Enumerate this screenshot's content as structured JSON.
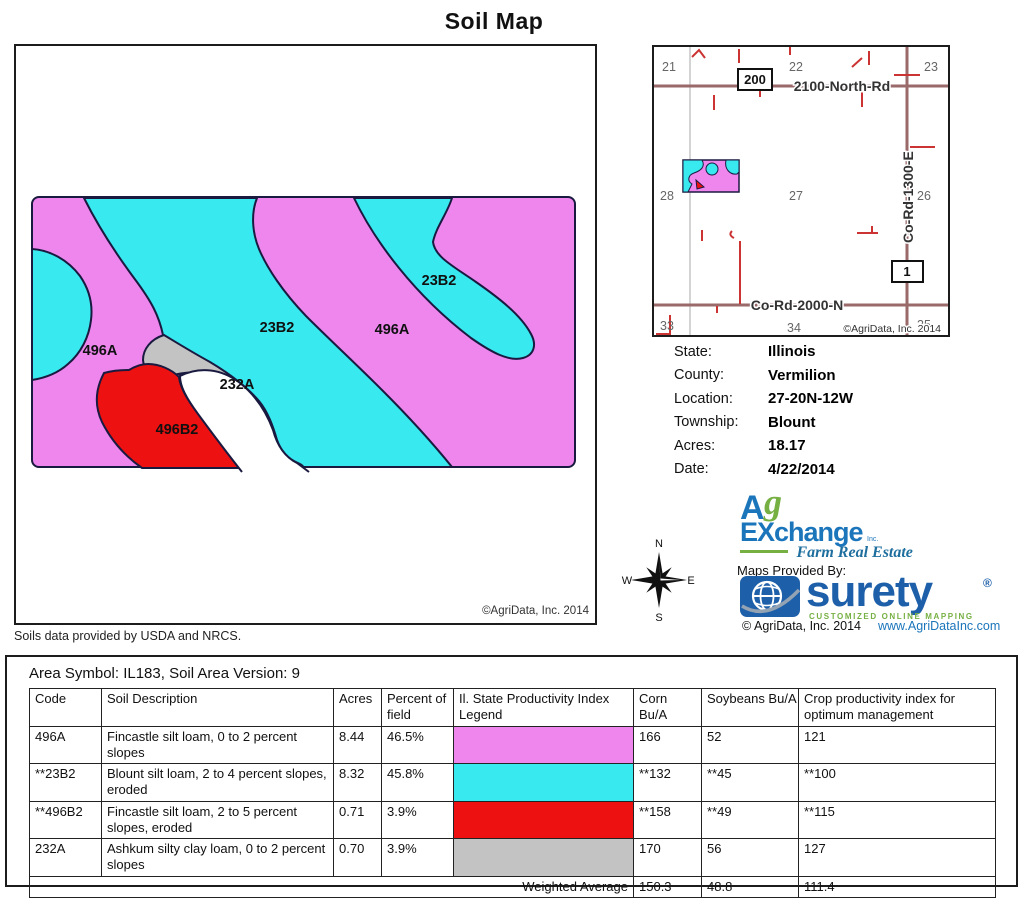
{
  "title": "Soil Map",
  "colors": {
    "magenta": "#EE86EE",
    "cyan": "#38E9F0",
    "red": "#EE1111",
    "gray": "#C3C3C3",
    "outline": "#1a1a40",
    "road": "#9a6a6a",
    "road_minor": "#cc3333",
    "logo_blue": "#1B75BB",
    "logo_green": "#76B043",
    "surety_blue": "#1D5FA9"
  },
  "soil_map": {
    "labels": {
      "left_496A": "496A",
      "center_23B2": "23B2",
      "mid_496A": "496A",
      "topright_23B2": "23B2",
      "gray_232A": "232A",
      "red_496B2": "496B2"
    },
    "copyright": "©AgriData, Inc. 2014",
    "note": "Soils data provided by USDA and NRCS."
  },
  "locator": {
    "sections": [
      "21",
      "22",
      "23",
      "28",
      "27",
      "26",
      "33",
      "34",
      "35"
    ],
    "roads": {
      "north_rd": "2100-North-Rd",
      "co_rd_2000": "Co-Rd-2000-N",
      "co_rd_1300": "Co-Rd-1300-E"
    },
    "markers": {
      "m200": "200",
      "m1": "1"
    },
    "copyright": "©AgriData, Inc. 2014"
  },
  "info": {
    "rows": [
      {
        "label": "State:",
        "value": "Illinois"
      },
      {
        "label": "County:",
        "value": "Vermilion"
      },
      {
        "label": "Location:",
        "value": "27-20N-12W"
      },
      {
        "label": "Township:",
        "value": "Blount"
      },
      {
        "label": "Acres:",
        "value": "18.17"
      },
      {
        "label": "Date:",
        "value": "4/22/2014"
      }
    ]
  },
  "compass": {
    "n": "N",
    "e": "E",
    "s": "S",
    "w": "W"
  },
  "logos": {
    "agx_a": "A",
    "agx_g": "g",
    "agx_exchange": "EXchange",
    "agx_inc": "Inc.",
    "agx_tagline": "Farm Real Estate",
    "maps_provided": "Maps Provided By:",
    "surety": "surety",
    "reg": "®",
    "surety_tagline": "CUSTOMIZED ONLINE MAPPING",
    "agridata_copyright": "© AgriData, Inc. 2014",
    "website": "www.AgriDataInc.com"
  },
  "soil_table": {
    "area_line": "Area Symbol: IL183, Soil Area Version: 9",
    "headers": [
      "Code",
      "Soil Description",
      "Acres",
      "Percent of field",
      "Il. State Productivity Index Legend",
      "Corn Bu/A",
      "Soybeans Bu/A",
      "Crop productivity index for optimum management"
    ],
    "rows": [
      {
        "code": "496A",
        "desc": "Fincastle silt loam, 0 to 2 percent slopes",
        "acres": "8.44",
        "pct": "46.5%",
        "corn": "166",
        "soy": "52",
        "cpi": "121"
      },
      {
        "code": "**23B2",
        "desc": "Blount silt loam, 2 to 4 percent slopes, eroded",
        "acres": "8.32",
        "pct": "45.8%",
        "corn": "**132",
        "soy": "**45",
        "cpi": "**100"
      },
      {
        "code": "**496B2",
        "desc": "Fincastle silt loam, 2 to 5 percent slopes, eroded",
        "acres": "0.71",
        "pct": "3.9%",
        "corn": "**158",
        "soy": "**49",
        "cpi": "**115"
      },
      {
        "code": "232A",
        "desc": "Ashkum silty clay loam, 0 to 2 percent slopes",
        "acres": "0.70",
        "pct": "3.9%",
        "corn": "170",
        "soy": "56",
        "cpi": "127"
      }
    ],
    "weighted": {
      "label": "Weighted Average",
      "corn": "150.3",
      "soy": "48.8",
      "cpi": "111.4"
    }
  }
}
